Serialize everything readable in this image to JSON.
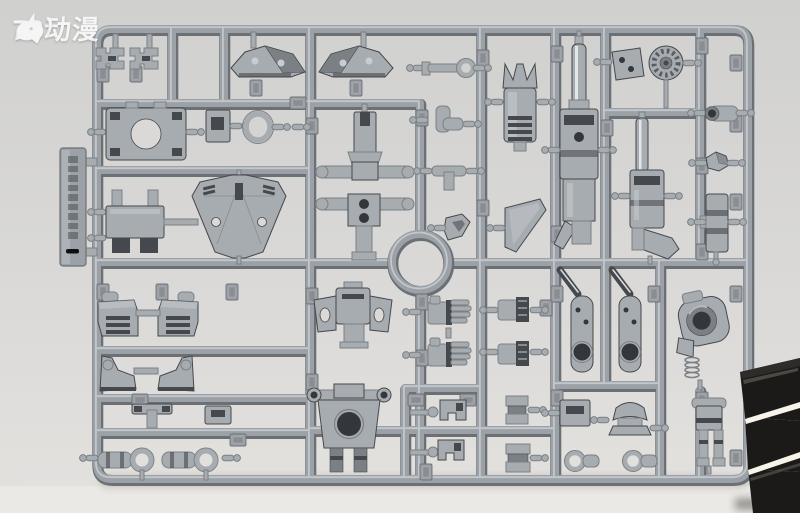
{
  "watermark": {
    "icon": "unicorn-logo",
    "text": "78动漫"
  },
  "colors": {
    "bg-top": "#d0d0ce",
    "bg-mid": "#dad9d7",
    "bg-bottom": "#e4e2df",
    "floor": "#eceae7",
    "rail-mid": "#9ba1a6",
    "rail-dark": "#6b7075",
    "rail-light": "#ccd1d5",
    "part-mid": "#a7acb0",
    "part-dark": "#7b8084",
    "part-deep": "#45484c",
    "part-light": "#c9cdd1",
    "metal-shine": "#e9ecee",
    "clip-dark": "#1b1a18",
    "clip-mid": "#2e2c29",
    "clip-streak": "#f8f4ea",
    "watermark-color": "#ffffff",
    "shadow": "#8a8886"
  }
}
